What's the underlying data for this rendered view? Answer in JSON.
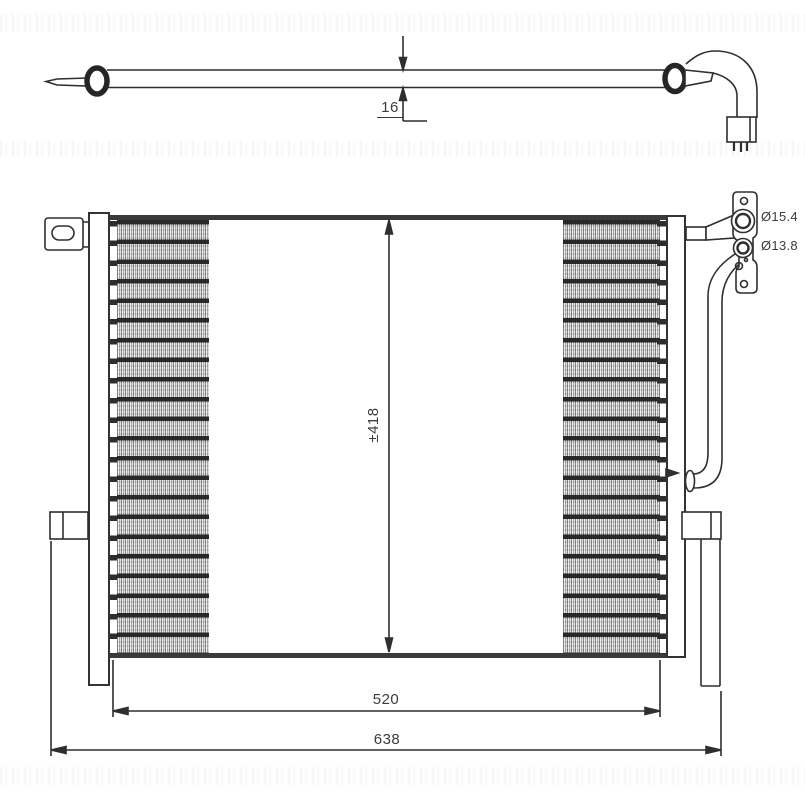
{
  "drawing": {
    "dim_tube_diameter": "16",
    "dim_core_height": "±418",
    "dim_core_width": "520",
    "dim_overall_width": "638",
    "port_upper_diameter": "Ø15.4",
    "port_lower_diameter": "Ø13.8"
  },
  "colors": {
    "line": "#2f2f2f",
    "background": "#ffffff",
    "fin_fill": "#c9c9c9"
  }
}
